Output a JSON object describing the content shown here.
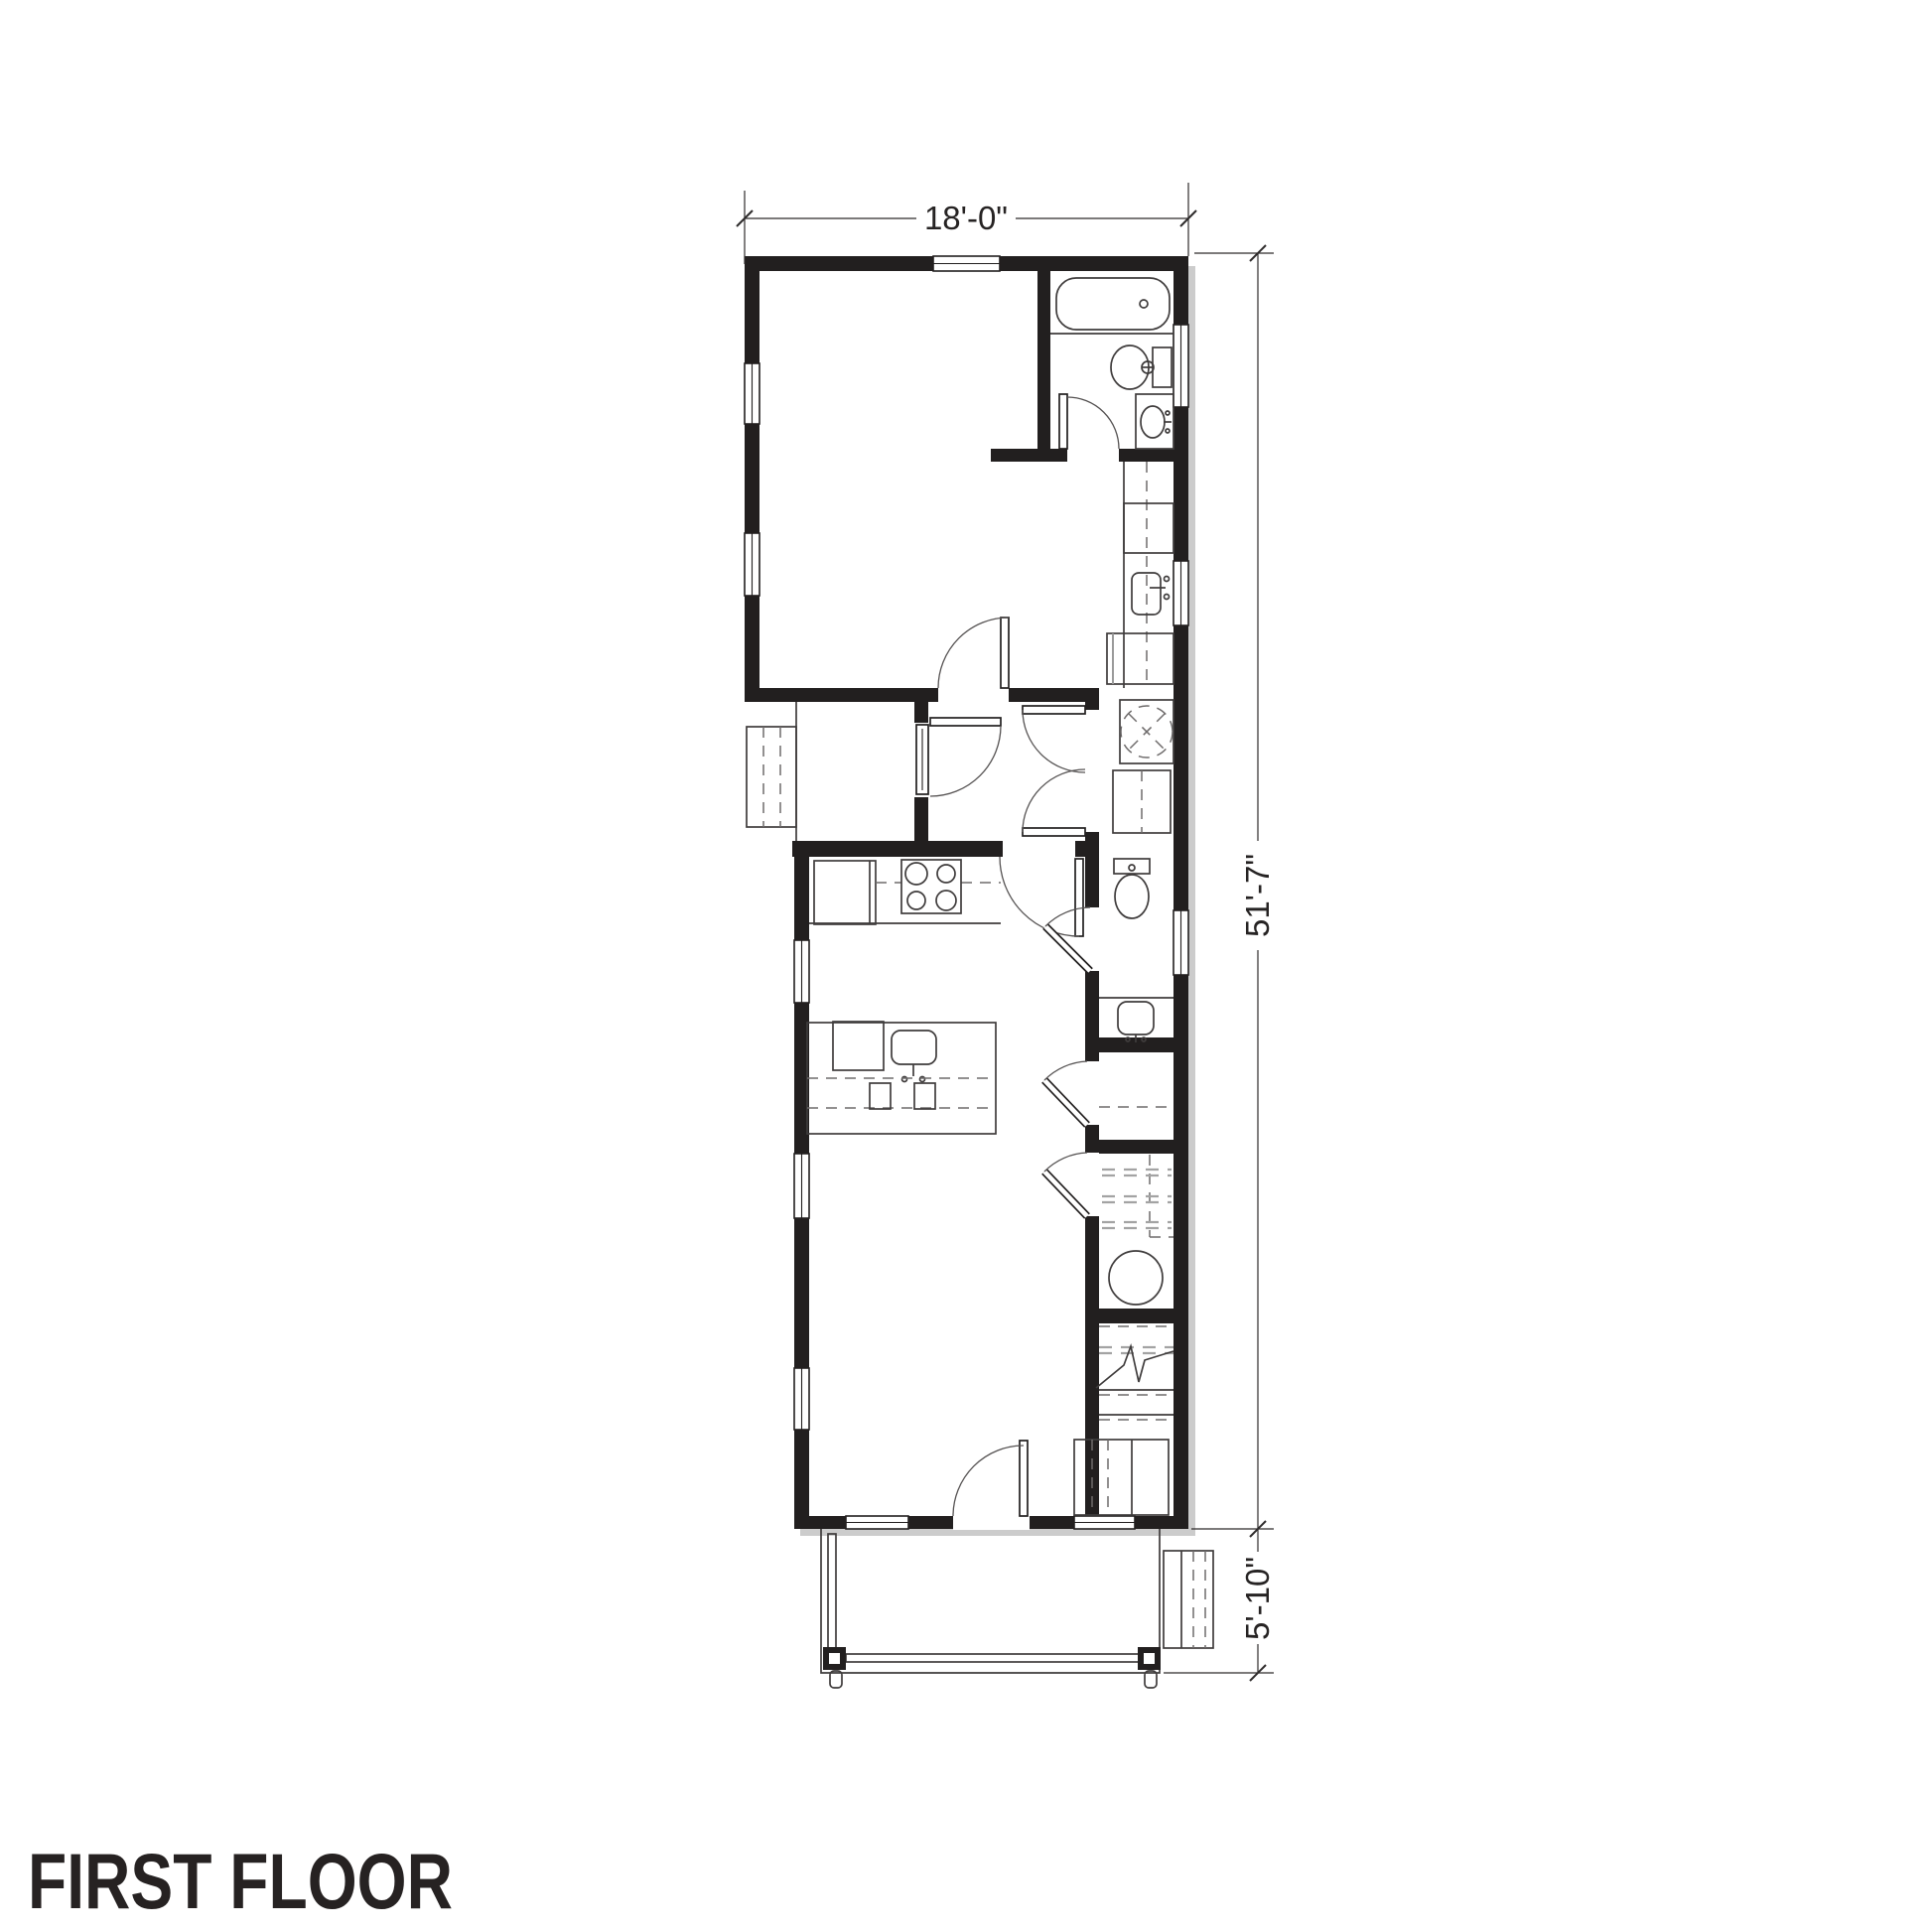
{
  "drawing": {
    "title": "FIRST FLOOR",
    "dimensions": {
      "overall_width": "18'-0\"",
      "overall_depth": "51'-7\"",
      "porch_depth": "5'-10\""
    },
    "colors": {
      "paper": "#ffffff",
      "wall_ink": "#221f1f",
      "fixture_line": "#3f3c3c",
      "dashed_line": "#6f6c6c",
      "wall_shadow": "#cccccc"
    },
    "fixtures": [
      "bathtub",
      "toilet",
      "vanity-sink",
      "utility-counter",
      "utility-sink",
      "washer",
      "dryer",
      "refrigerator",
      "range-cooktop",
      "kitchen-island",
      "island-sink",
      "dishwasher",
      "island-stools",
      "half-bath-toilet",
      "half-bath-sink",
      "closet-shelves",
      "water-heater",
      "staircase",
      "front-door",
      "side-door",
      "porch-railing",
      "porch-posts",
      "porch-steps",
      "side-steps"
    ]
  }
}
